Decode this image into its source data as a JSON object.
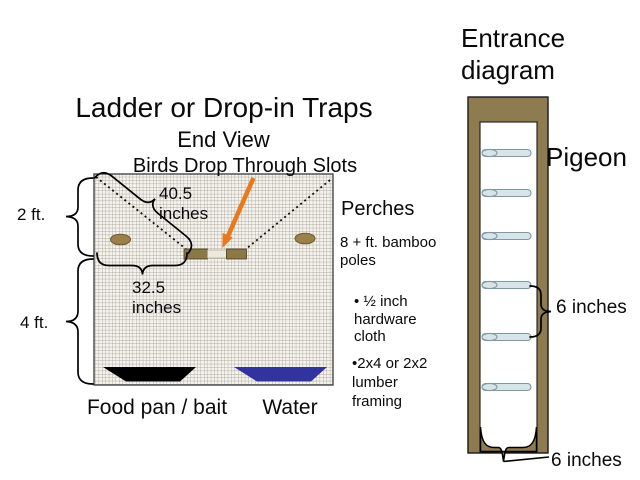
{
  "slide": {
    "title": "Ladder or Drop-in Traps",
    "subtitle": "End View",
    "caption": "Birds Drop Through Slots"
  },
  "trap_diagram": {
    "height_upper": "2 ft.",
    "height_lower": "4 ft.",
    "diagonal_dim": "40.5\ninches",
    "width_dim": "32.5\ninches",
    "food_label": "Food pan / bait",
    "water_label": "Water"
  },
  "perches_notes": {
    "heading": "Perches",
    "subheading": "8 + ft. bamboo\npoles",
    "bullet_hardware": "• ½ inch\nhardware\ncloth",
    "bullet_lumber": "•2x4 or 2x2\nlumber\nframing"
  },
  "entrance_diagram": {
    "heading": "Entrance\ndiagram",
    "pigeon_label": "Pigeon",
    "perch_spacing": "6 inches",
    "opening_width": "6 inches",
    "perch_count": 6
  },
  "colors": {
    "frame_brown": "#8E7C50",
    "perch_tan": "#9C8049",
    "pole_blue": "#D7E4E8",
    "slot_brown": "#8A7947",
    "arrow_orange": "#E8791E",
    "water_blue": "#3333A0",
    "pan_black": "#000000"
  }
}
